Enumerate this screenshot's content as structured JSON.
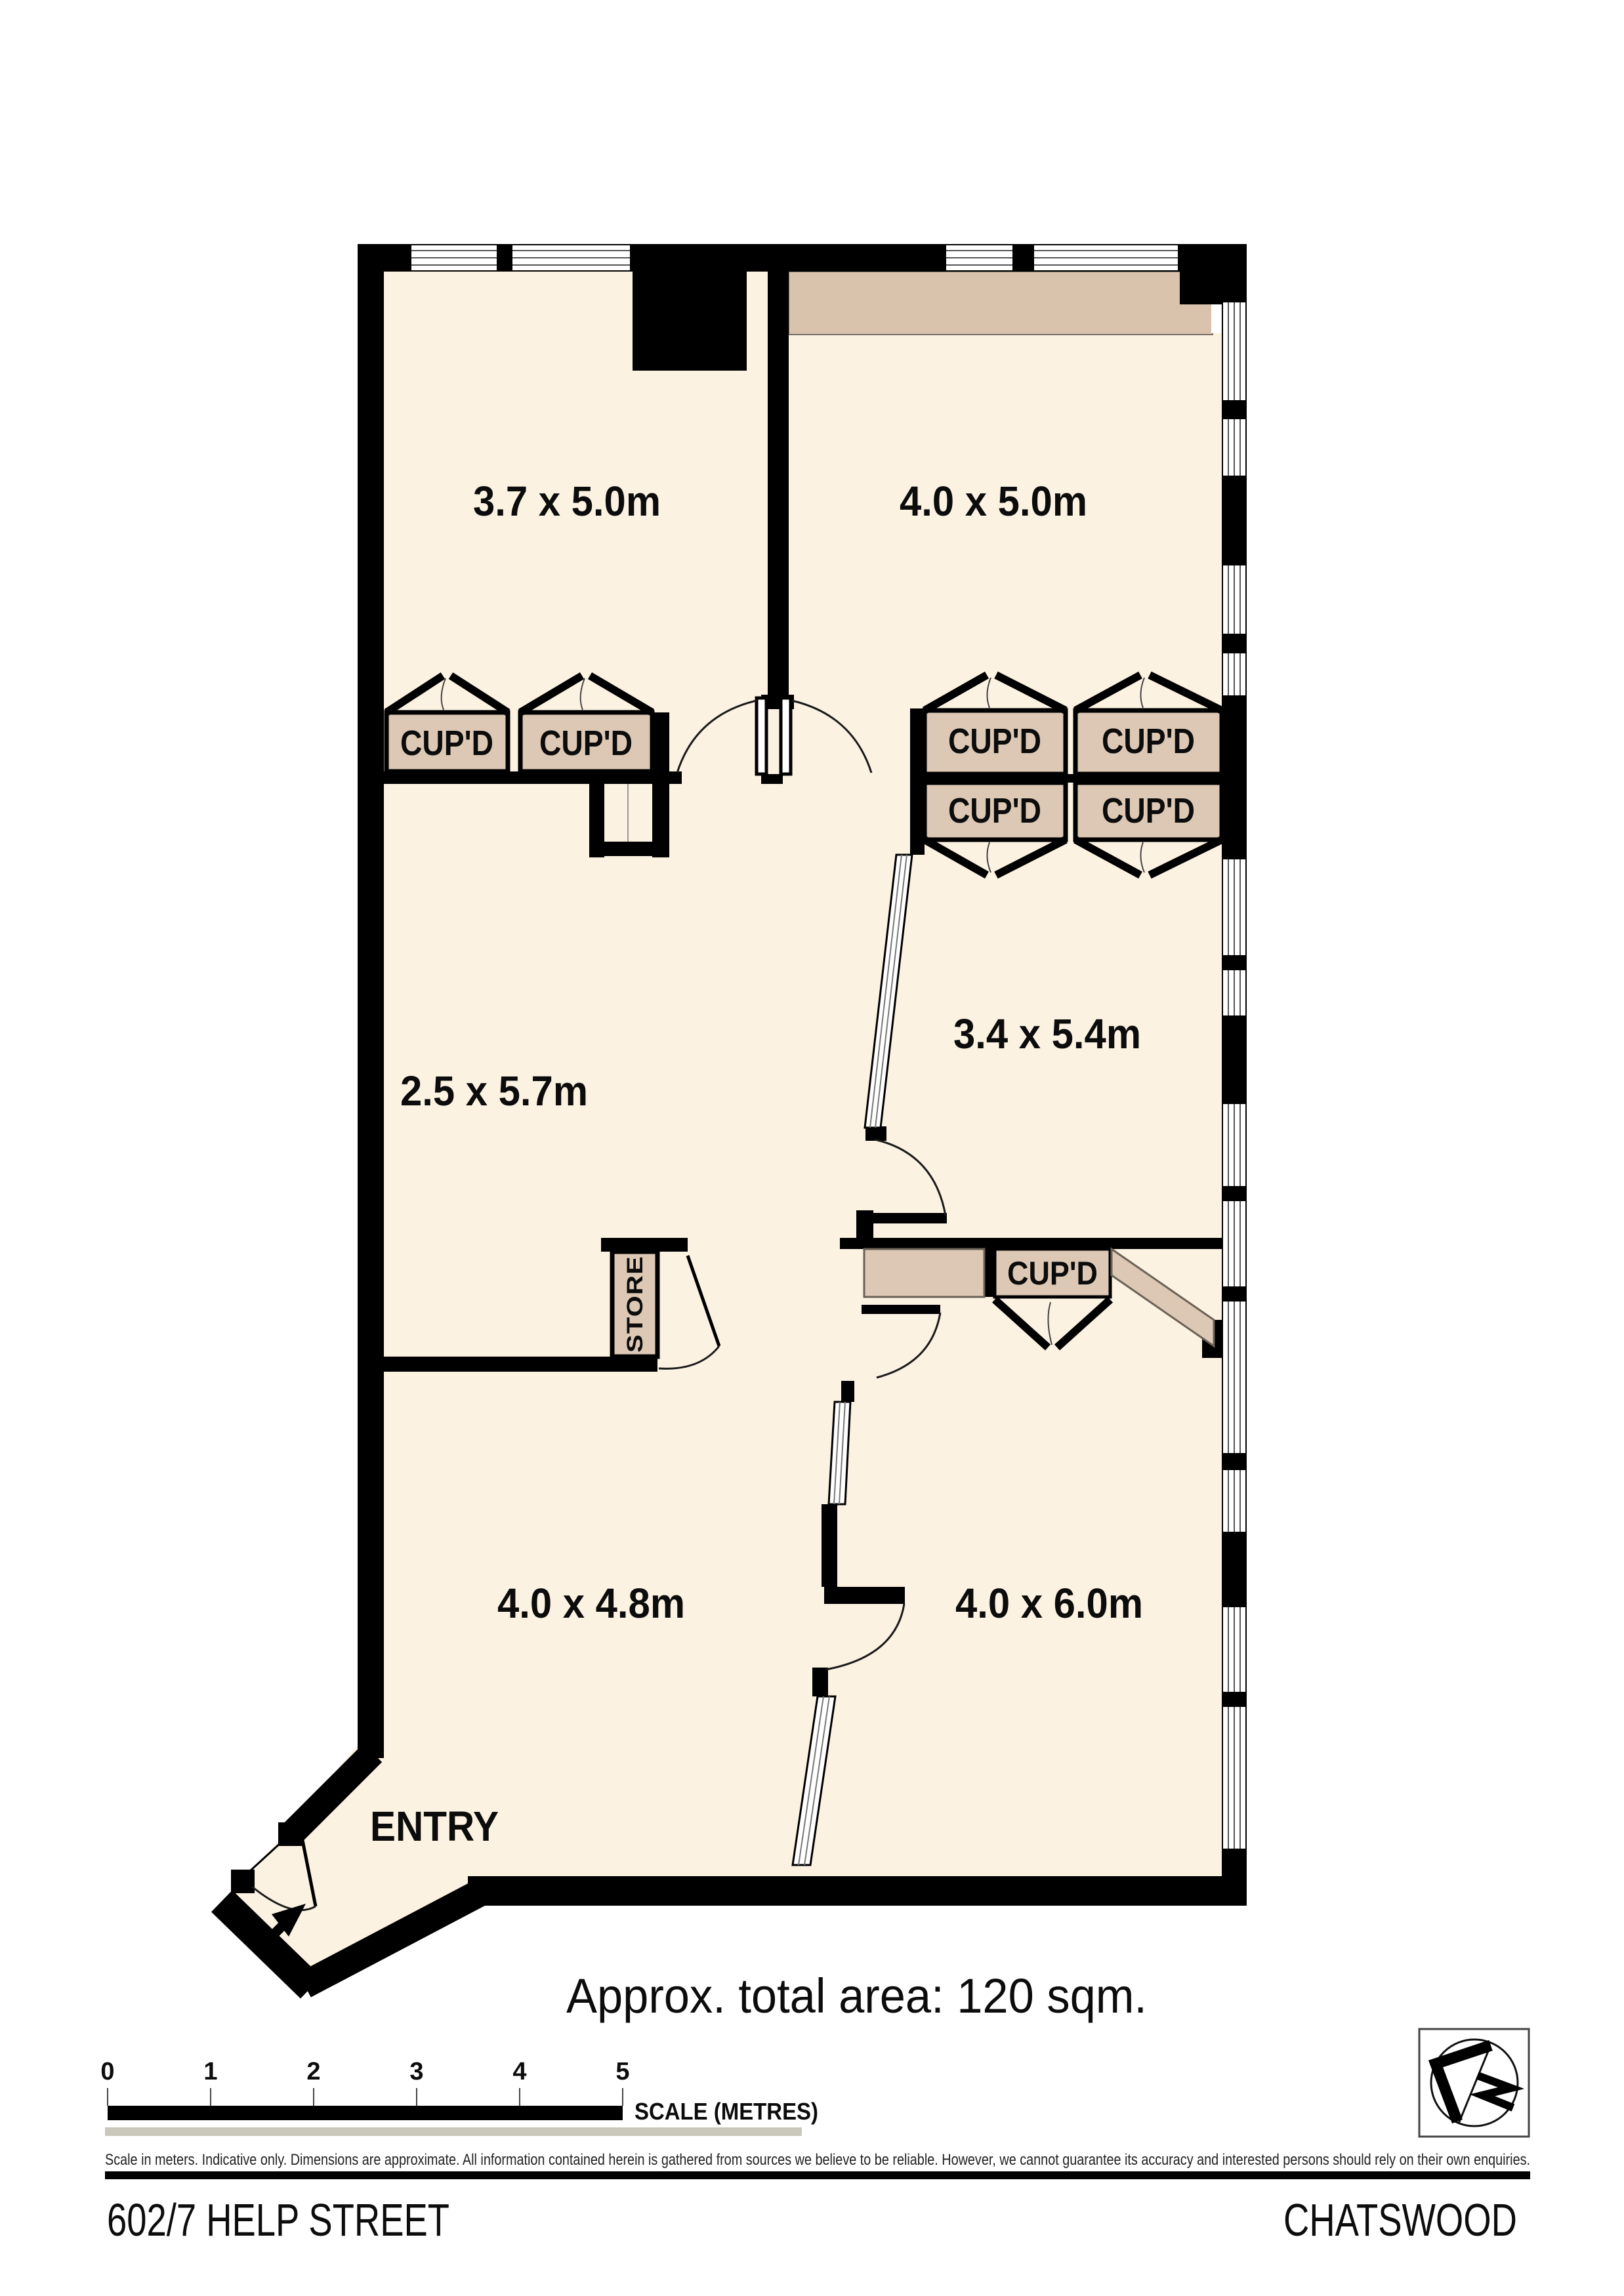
{
  "plan": {
    "colors": {
      "floor": "#fcf2e2",
      "cupboard": "#dcc8b4",
      "bulkhead": "#d9c3ad",
      "wall": "#000000",
      "outline": "#6a6156"
    },
    "rooms": [
      {
        "name": "top-left-room",
        "label": "3.7 x 5.0m"
      },
      {
        "name": "top-right-room",
        "label": "4.0 x 5.0m"
      },
      {
        "name": "hallway",
        "label": "2.5 x 5.7m"
      },
      {
        "name": "middle-right-room",
        "label": "3.4 x 5.4m"
      },
      {
        "name": "bottom-left-room",
        "label": "4.0 x 4.8m"
      },
      {
        "name": "bottom-right-room",
        "label": "4.0 x 6.0m"
      }
    ],
    "cupboard_label": "CUP'D",
    "store_label": "STORE",
    "entry_label": "ENTRY"
  },
  "annotations": {
    "area_note": "Approx. total area: 120 sqm.",
    "scale_ticks": [
      "0",
      "1",
      "2",
      "3",
      "4",
      "5"
    ],
    "scale_label": "SCALE (METRES)",
    "disclaimer": "Scale in meters. Indicative only. Dimensions are approximate. All information contained herein is gathered from sources we believe to be reliable. However, we cannot guarantee its accuracy and interested persons should rely on their own enquiries."
  },
  "footer": {
    "address": "602/7 HELP STREET",
    "suburb": "CHATSWOOD"
  }
}
